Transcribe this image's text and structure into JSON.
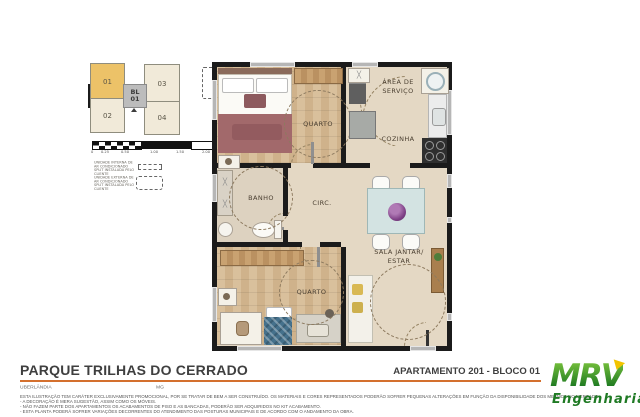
{
  "key_plan": {
    "block": {
      "line1": "BL",
      "line2": "01"
    },
    "units": [
      "01",
      "02",
      "03",
      "04"
    ]
  },
  "scale_bar": {
    "labels": [
      "0",
      "0.25",
      "0.50",
      "1.00",
      "1.50",
      "2.00"
    ]
  },
  "legend": {
    "item1": "UNIDADE INTERNA DE AR CONDICIONADO SPLIT INSTALADA PELO CLIENTE",
    "item2": "UNIDADE EXTERNA DE AR CONDICIONADO SPLIT INSTALADA PELO CLIENTE"
  },
  "floor_plan": {
    "rooms": {
      "quarto1": "QUARTO",
      "area_servico_line1": "ÁREA DE",
      "area_servico_line2": "SERVIÇO",
      "cozinha": "COZINHA",
      "banho": "BANHO",
      "circ": "CIRC.",
      "sala_line1": "SALA JANTAR/",
      "sala_line2": "ESTAR",
      "quarto2": "QUARTO"
    }
  },
  "footer": {
    "project": "PARQUE TRILHAS DO CERRADO",
    "city": "UBERLÂNDIA",
    "state": "MG",
    "unit": "APARTAMENTO 201 - BLOCO 01",
    "disclaimer": [
      "ESTA ILUSTRAÇÃO TEM CARÁTER EXCLUSIVAMENTE PROMOCIONAL, POR SE TRATAR DE BEM A SER CONSTRUÍDO. OS MATERIAIS E CORES REPRESENTADOS PODERÃO SOFRER PEQUENAS ALTERAÇÕES EM FUNÇÃO DA DISPONIBILIDADE DOS MESMOS NO MERCADO.",
      "- A DECORAÇÃO É MERA SUGESTÃO, ASSIM COMO OS MÓVEIS.",
      "- NÃO FAZEM PARTE DOS APARTAMENTOS OS ACABAMENTOS DE PISO E AS BANCADAS, PODERÃO SER ADQUIRIDOS NO KIT ACABAMENTO.",
      "- ESTA PLANTA PODERÁ SOFRER VARIAÇÕES DECORRENTES DO ATENDIMENTO DAS POSTURAS MUNICIPAIS E DE ACORDO COM O ANDAMENTO DA OBRA."
    ]
  },
  "logo": {
    "name": "MRV",
    "subtitle": "Engenharia"
  },
  "colors": {
    "accent_orange": "#d4702e",
    "highlighted_unit": "#ecc268",
    "logo_green": "#1e7a22",
    "logo_yellow": "#f2c400",
    "wall_black": "#1b1b1b",
    "floor_beige": "#e4d8c4"
  }
}
